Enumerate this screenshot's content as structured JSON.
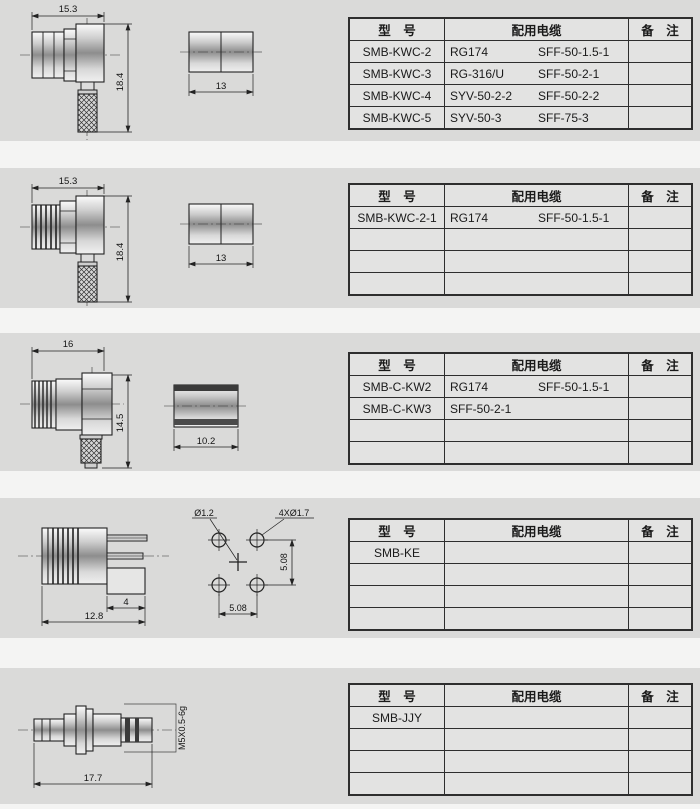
{
  "table_header": {
    "model": "型　号",
    "cable": "配用电缆",
    "remark": "备　注"
  },
  "sections": [
    {
      "name": "SMB-KWC right-angle crimp plug",
      "dims": {
        "width": "15.3",
        "height": "18.4",
        "part": "13"
      },
      "rows": [
        {
          "model": "SMB-KWC-2",
          "cable1": "RG174",
          "cable2": "SFF-50-1.5-1"
        },
        {
          "model": "SMB-KWC-3",
          "cable1": "RG-316/U",
          "cable2": "SFF-50-2-1"
        },
        {
          "model": "SMB-KWC-4",
          "cable1": "SYV-50-2-2",
          "cable2": "SFF-50-2-2"
        },
        {
          "model": "SMB-KWC-5",
          "cable1": "SYV-50-3",
          "cable2": "SFF-75-3"
        }
      ]
    },
    {
      "name": "SMB-KWC-2-1 right-angle crimp plug",
      "dims": {
        "width": "15.3",
        "height": "18.4",
        "part": "13"
      },
      "rows": [
        {
          "model": "SMB-KWC-2-1",
          "cable1": "RG174",
          "cable2": "SFF-50-1.5-1"
        },
        {},
        {},
        {}
      ]
    },
    {
      "name": "SMB-C-KW right-angle jack",
      "dims": {
        "width": "16",
        "height": "14.5",
        "part": "10.2"
      },
      "rows": [
        {
          "model": "SMB-C-KW2",
          "cable1": "RG174",
          "cable2": "SFF-50-1.5-1"
        },
        {
          "model": "SMB-C-KW3",
          "cable1": "SFF-50-2-1"
        },
        {},
        {}
      ]
    },
    {
      "name": "SMB-KE PCB mount jack",
      "dims": {
        "pin": "4",
        "width": "12.8",
        "hole": "Ø1.2",
        "pads": "4XØ1.7",
        "pitch_x": "5.08",
        "pitch_y": "5.08"
      },
      "rows": [
        {
          "model": "SMB-KE"
        },
        {},
        {},
        {}
      ]
    },
    {
      "name": "SMB-JJY bulkhead adapter",
      "dims": {
        "width": "17.7",
        "thread": "M5X0.5-6g"
      },
      "rows": [
        {
          "model": "SMB-JJY"
        },
        {},
        {},
        {}
      ]
    }
  ]
}
